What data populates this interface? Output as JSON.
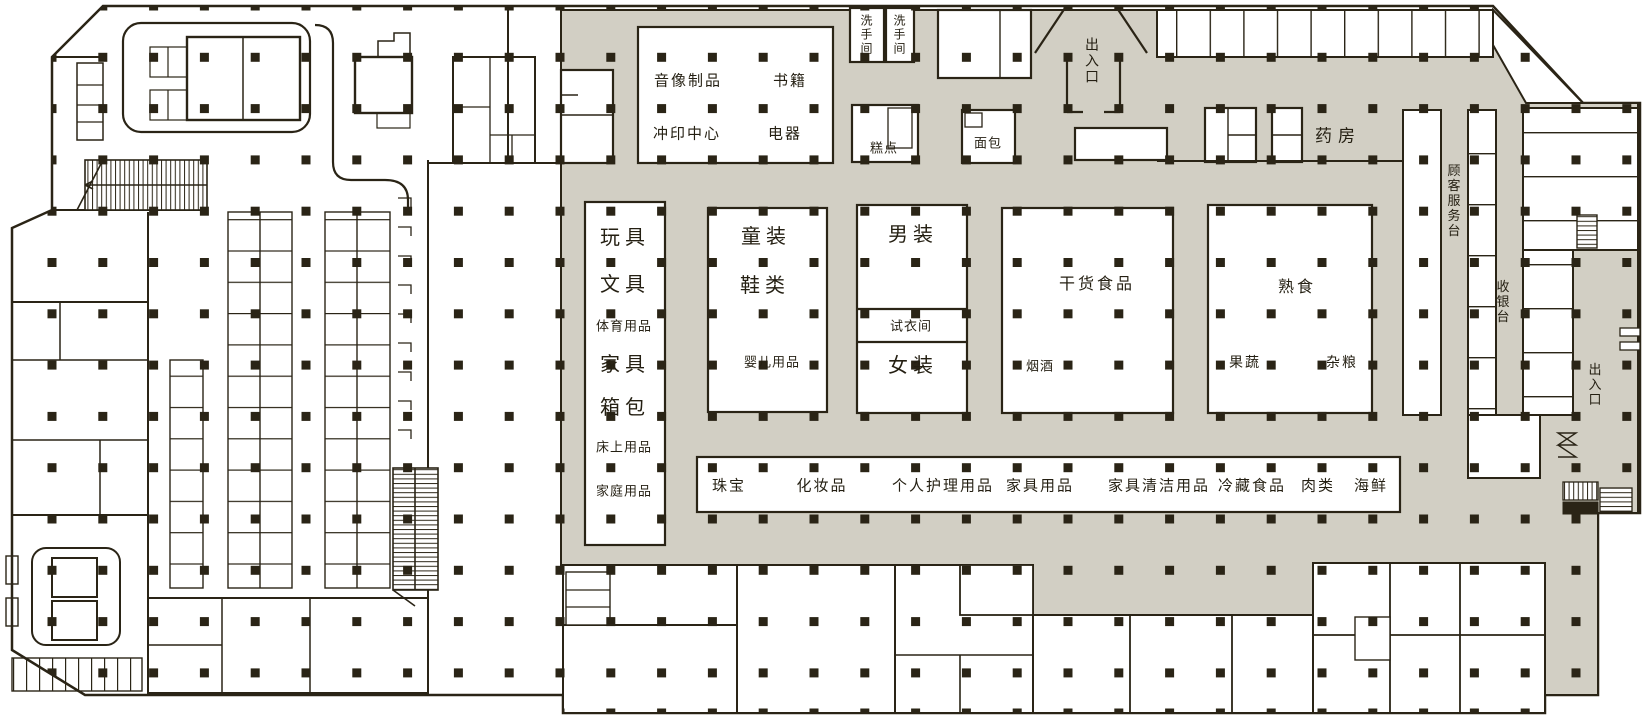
{
  "title": "超市平面图",
  "colors": {
    "floor_gray": "#d2cfc4",
    "line": "#2a2416",
    "background": "#ffffff"
  },
  "areas": {
    "restroom_1": "洗手间",
    "restroom_2": "洗手间",
    "entrance_top": "出入口",
    "pharmacy": "药房",
    "av_products": "音像制品",
    "books": "书籍",
    "photo_center": "冲印中心",
    "appliances": "电器",
    "pastry": "糕点",
    "bread": "面包",
    "toys": "玩具",
    "stationery": "文具",
    "sports_goods": "体育用品",
    "furniture": "家具",
    "bags": "箱包",
    "bedding": "床上用品",
    "household": "家庭用品",
    "kids_wear": "童装",
    "shoes": "鞋类",
    "baby_products": "婴儿用品",
    "mens_wear": "男装",
    "fitting_room": "试衣间",
    "womens_wear": "女装",
    "dry_food": "干货食品",
    "tobacco_liquor": "烟酒",
    "deli": "熟食",
    "produce": "果蔬",
    "grains": "杂粮",
    "customer_service": "顾客服务台",
    "cashier": "收银台",
    "entrance_right": "出入口",
    "jewelry": "珠宝",
    "cosmetics": "化妆品",
    "personal_care": "个人护理用品",
    "furniture_goods": "家具用品",
    "cleaning_goods": "家具清洁用品",
    "chilled_food": "冷藏食品",
    "meat": "肉类",
    "seafood": "海鲜"
  }
}
